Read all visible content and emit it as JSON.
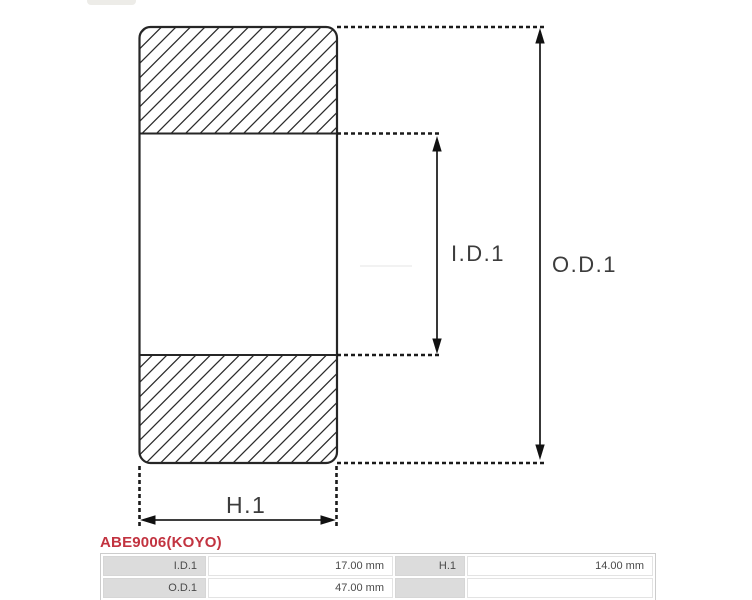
{
  "diagram": {
    "labels": {
      "inner_diameter": "I.D.1",
      "outer_diameter": "O.D.1",
      "width_dim": "H.1"
    }
  },
  "product": {
    "code": "ABE9006(KOYO)"
  },
  "spec_table": {
    "rows": [
      {
        "label1": "I.D.1",
        "value1": "17.00 mm",
        "label2": "H.1",
        "value2": "14.00 mm"
      },
      {
        "label1": "O.D.1",
        "value1": "47.00 mm",
        "label2": "",
        "value2": ""
      }
    ]
  },
  "colors": {
    "accent_red": "#c23340",
    "drawing_line": "#262626",
    "table_label_bg": "#dcdcdc",
    "table_border": "#cccccc"
  }
}
